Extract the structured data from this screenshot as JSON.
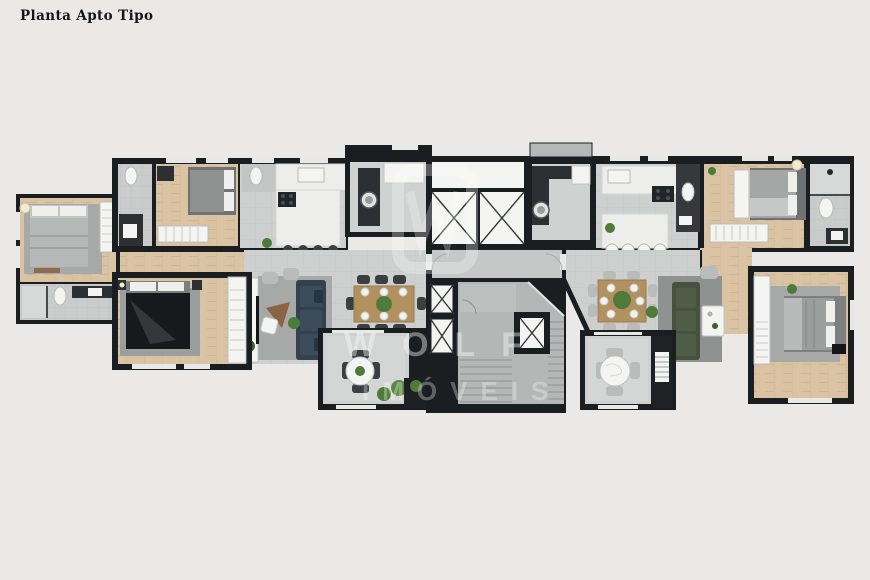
{
  "header": {
    "title": "Planta Apto Tipo"
  },
  "watermark": {
    "line1": "WOLF",
    "line2": "IMÓVEIS"
  },
  "palette": {
    "background": "#eae9e7",
    "walls": "#1b1e20",
    "wood_floor": "#d9c3a2",
    "tile_floor": "#cdd0cf",
    "bath_tile": "#c9cccb",
    "balcony_floor": "#ced1d0",
    "marble_counter": "#ededec",
    "granite_counter": "#2d3032",
    "sofa_navy": "#33414f",
    "sofa_green": "#46523e",
    "dining_wood": "#b19160",
    "bed_dark": "#17191c",
    "rug_gray": "#9fa3a2",
    "plant_green": "#4e7a3a",
    "fixture_white": "#f4f4f3"
  },
  "plan": {
    "type": "apartment-floor-plan",
    "left_apartment_rooms": [
      "master-suite",
      "suite-bathroom",
      "bathroom",
      "bedroom-2",
      "kitchen",
      "lavabo",
      "laundry",
      "living-dining",
      "balcony",
      "bedroom-3"
    ],
    "core": [
      "elevator-1",
      "elevator-2",
      "hall-corridor",
      "shaft-1",
      "shaft-2",
      "stairwell"
    ],
    "right_apartment_rooms": [
      "kitchen",
      "lavabo",
      "laundry",
      "bedroom-2",
      "bathroom",
      "living-dining",
      "balcony",
      "master-suite",
      "suite-bathroom"
    ]
  }
}
